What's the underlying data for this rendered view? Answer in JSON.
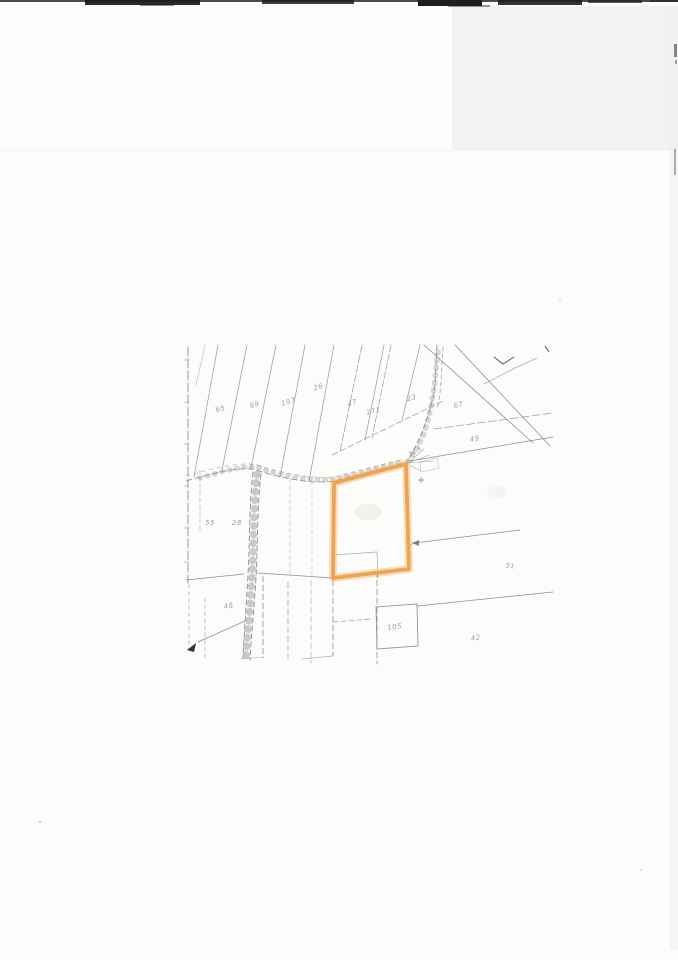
{
  "scan": {
    "background_color": "#fcfcfb",
    "edge_color": "#1e1e1e"
  },
  "map": {
    "line_color": "#8e8e8e",
    "highlight_color": "#ea9f4e",
    "highlight_glow": "#f4ba6c",
    "parcel_labels": [
      {
        "text": "65",
        "x": 221,
        "y": 411,
        "rot": -14,
        "size": 7
      },
      {
        "text": "99",
        "x": 255,
        "y": 407,
        "rot": -14,
        "size": 7
      },
      {
        "text": "197",
        "x": 289,
        "y": 404,
        "rot": -14,
        "size": 7
      },
      {
        "text": "26",
        "x": 319,
        "y": 389,
        "rot": -18,
        "size": 7
      },
      {
        "text": "47",
        "x": 353,
        "y": 405,
        "rot": -18,
        "size": 7
      },
      {
        "text": "271",
        "x": 374,
        "y": 413,
        "rot": -14,
        "size": 6.5
      },
      {
        "text": "23",
        "x": 412,
        "y": 400,
        "rot": -14,
        "size": 7
      },
      {
        "text": "67",
        "x": 459,
        "y": 407,
        "rot": -14,
        "size": 7
      },
      {
        "text": "49",
        "x": 475,
        "y": 441,
        "rot": -10,
        "size": 7
      },
      {
        "text": "76.5",
        "x": 416,
        "y": 453,
        "rot": -28,
        "size": 5.5
      },
      {
        "text": "55",
        "x": 210,
        "y": 525,
        "rot": 0,
        "size": 7
      },
      {
        "text": "28",
        "x": 237,
        "y": 525,
        "rot": 0,
        "size": 7
      },
      {
        "text": "48",
        "x": 229,
        "y": 608,
        "rot": -10,
        "size": 7
      },
      {
        "text": "51",
        "x": 510,
        "y": 568,
        "rot": 8,
        "size": 6.5
      },
      {
        "text": "105",
        "x": 395,
        "y": 629,
        "rot": -8,
        "size": 7
      },
      {
        "text": "42",
        "x": 476,
        "y": 640,
        "rot": -8,
        "size": 7
      }
    ]
  }
}
